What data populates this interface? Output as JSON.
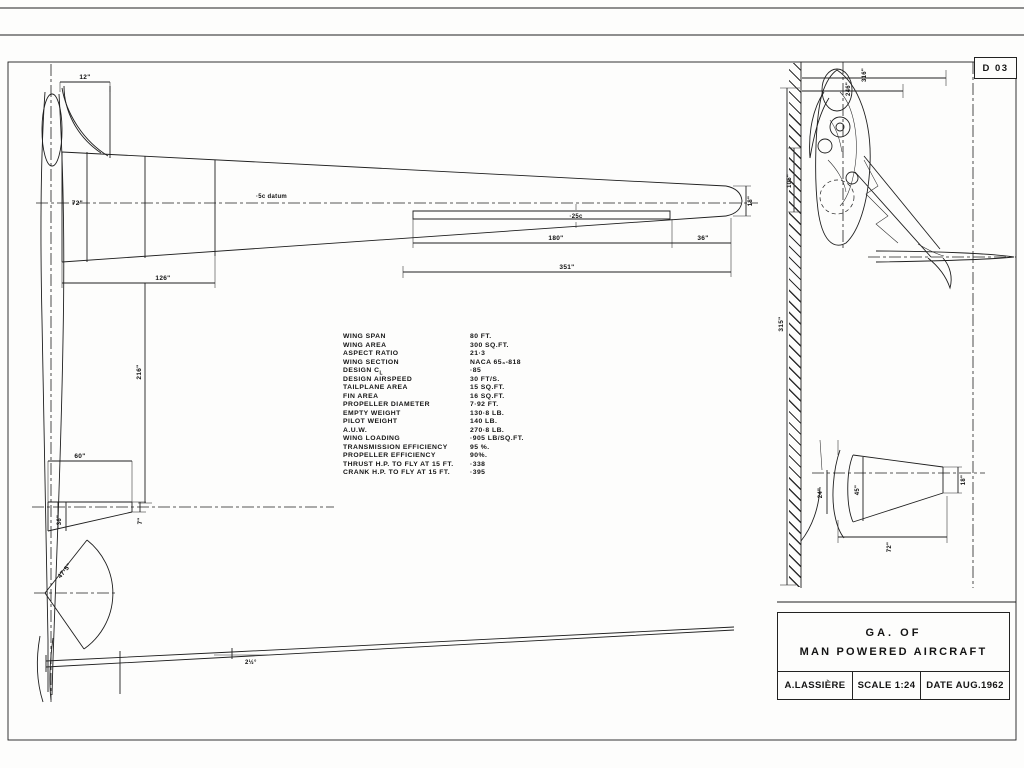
{
  "sheet": {
    "code": "D 03"
  },
  "title_block": {
    "line1": "GA.  OF",
    "line2": "MAN  POWERED  AIRCRAFT",
    "author": "A.LASSIÈRE",
    "scale": "SCALE 1:24",
    "date": "DATE AUG.1962"
  },
  "spec": {
    "rows": [
      {
        "label": "WING  SPAN",
        "value": "80 FT."
      },
      {
        "label": "WING  AREA",
        "value": "300  SQ.FT."
      },
      {
        "label": "ASPECT  RATIO",
        "value": "21·3"
      },
      {
        "label": "WING  SECTION",
        "value": "NACA  65₃-818"
      },
      {
        "label": "DESIGN  C",
        "sub": "L",
        "value": "·85"
      },
      {
        "label": "DESIGN  AIRSPEED",
        "value": "30  FT/S."
      },
      {
        "label": "TAILPLANE  AREA",
        "value": "15  SQ.FT."
      },
      {
        "label": "FIN  AREA",
        "value": "16  SQ.FT."
      },
      {
        "label": "PROPELLER  DIAMETER",
        "value": "7·92 FT."
      },
      {
        "label": "EMPTY  WEIGHT",
        "value": "130·8  LB."
      },
      {
        "label": "PILOT  WEIGHT",
        "value": "140   LB."
      },
      {
        "label": "A.U.W.",
        "value": "270·8  LB."
      },
      {
        "label": "WING  LOADING",
        "value": "·905  LB/SQ.FT."
      },
      {
        "label": "TRANSMISSION  EFFICIENCY",
        "value": "95 %."
      },
      {
        "label": "PROPELLER  EFFICIENCY",
        "value": "90%."
      },
      {
        "label": "THRUST H.P.  TO FLY AT  15 FT.",
        "value": "·338"
      },
      {
        "label": "CRANK  H.P.  TO FLY  AT  15 FT.",
        "value": "·395"
      }
    ]
  },
  "dims": {
    "blade_width": "12\"",
    "root_chord": "72\"",
    "datum": "·5c datum",
    "inner_panel": "126\"",
    "tail_arm": "216\"",
    "quarter_chord": "·25c",
    "aileron_span": "180\"",
    "tip_panel": "36\"",
    "outer_panel": "351\"",
    "tip_chord": "18\"",
    "tailplane_span": "60\"",
    "tailplane_root": "36\"",
    "tailplane_tip": "7\"",
    "prop_radius": "47·5\"",
    "dihedral": "2½°",
    "sv_overall": "316\"",
    "sv_nose": "246\"",
    "sv_length": "315\"",
    "sv_pod": "105\"",
    "fin_rudder": "24\"",
    "fin_root": "45\"",
    "fin_tip": "18\"",
    "fin_height": "72\""
  }
}
